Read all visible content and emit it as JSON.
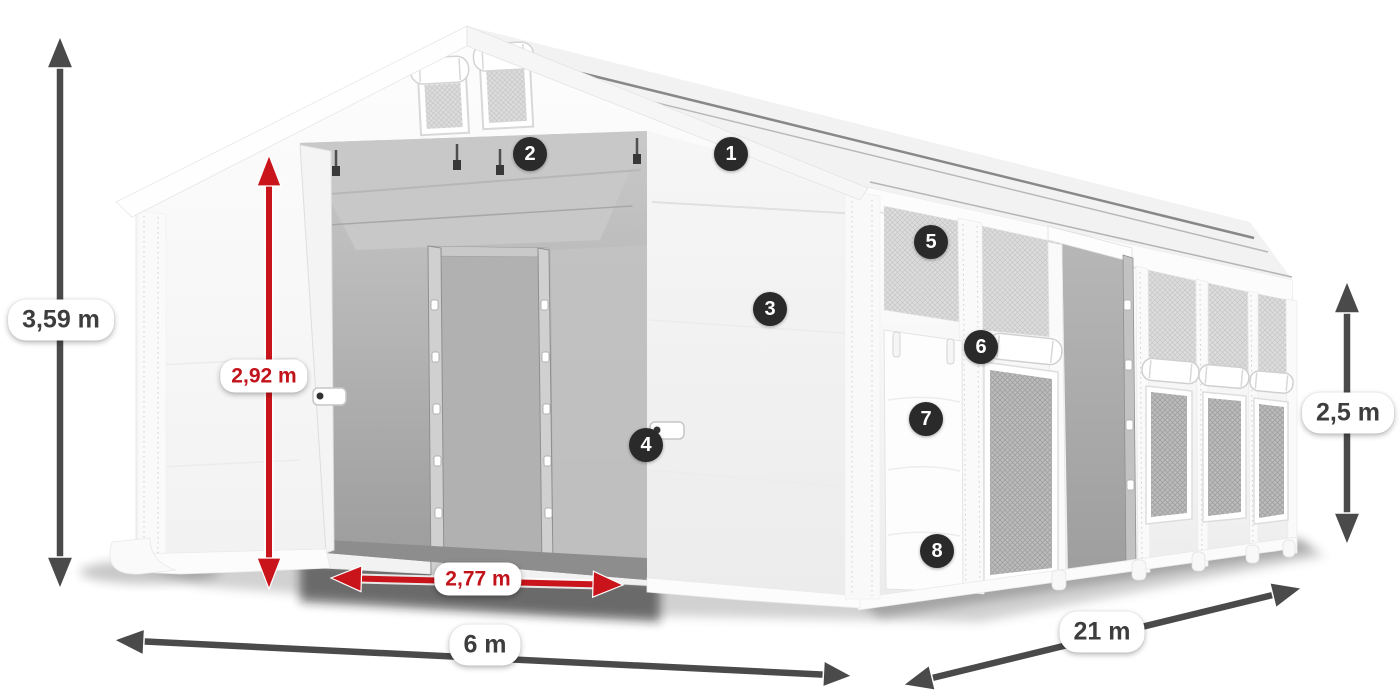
{
  "figure": {
    "description": "White 6 x 21 m PVC storage tent shown in perspective: front gable with two vent windows and wide open double door revealing grey interior and inner door frame; long side wall with mesh windows, roll-up covers and an open sliding door. Dimension arrows and numbered feature markers annotate the image.",
    "background_color": "#ffffff"
  },
  "colors": {
    "dimension_arrow_dark": "#4a4a4a",
    "dimension_arrow_red": "#c8141a",
    "label_text_dark": "#3d3d3d",
    "label_text_red": "#c2121a",
    "label_pill_background": "#ffffff",
    "badge_background": "#2a2a2a",
    "badge_text": "#ffffff",
    "tent_fabric": "#f7f7f7",
    "interior_grey": "#aeaeae"
  },
  "dimension_labels": {
    "total_height": {
      "text": "3,59 m",
      "style": "dark"
    },
    "clear_height": {
      "text": "2,92 m",
      "style": "red"
    },
    "door_width": {
      "text": "2,77 m",
      "style": "red"
    },
    "width": {
      "text": "6 m",
      "style": "dark"
    },
    "length": {
      "text": "21 m",
      "style": "dark"
    },
    "side_height": {
      "text": "2,5 m",
      "style": "dark"
    }
  },
  "badges": [
    {
      "label": "1"
    },
    {
      "label": "2"
    },
    {
      "label": "3"
    },
    {
      "label": "4"
    },
    {
      "label": "5"
    },
    {
      "label": "6"
    },
    {
      "label": "7"
    },
    {
      "label": "8"
    }
  ]
}
